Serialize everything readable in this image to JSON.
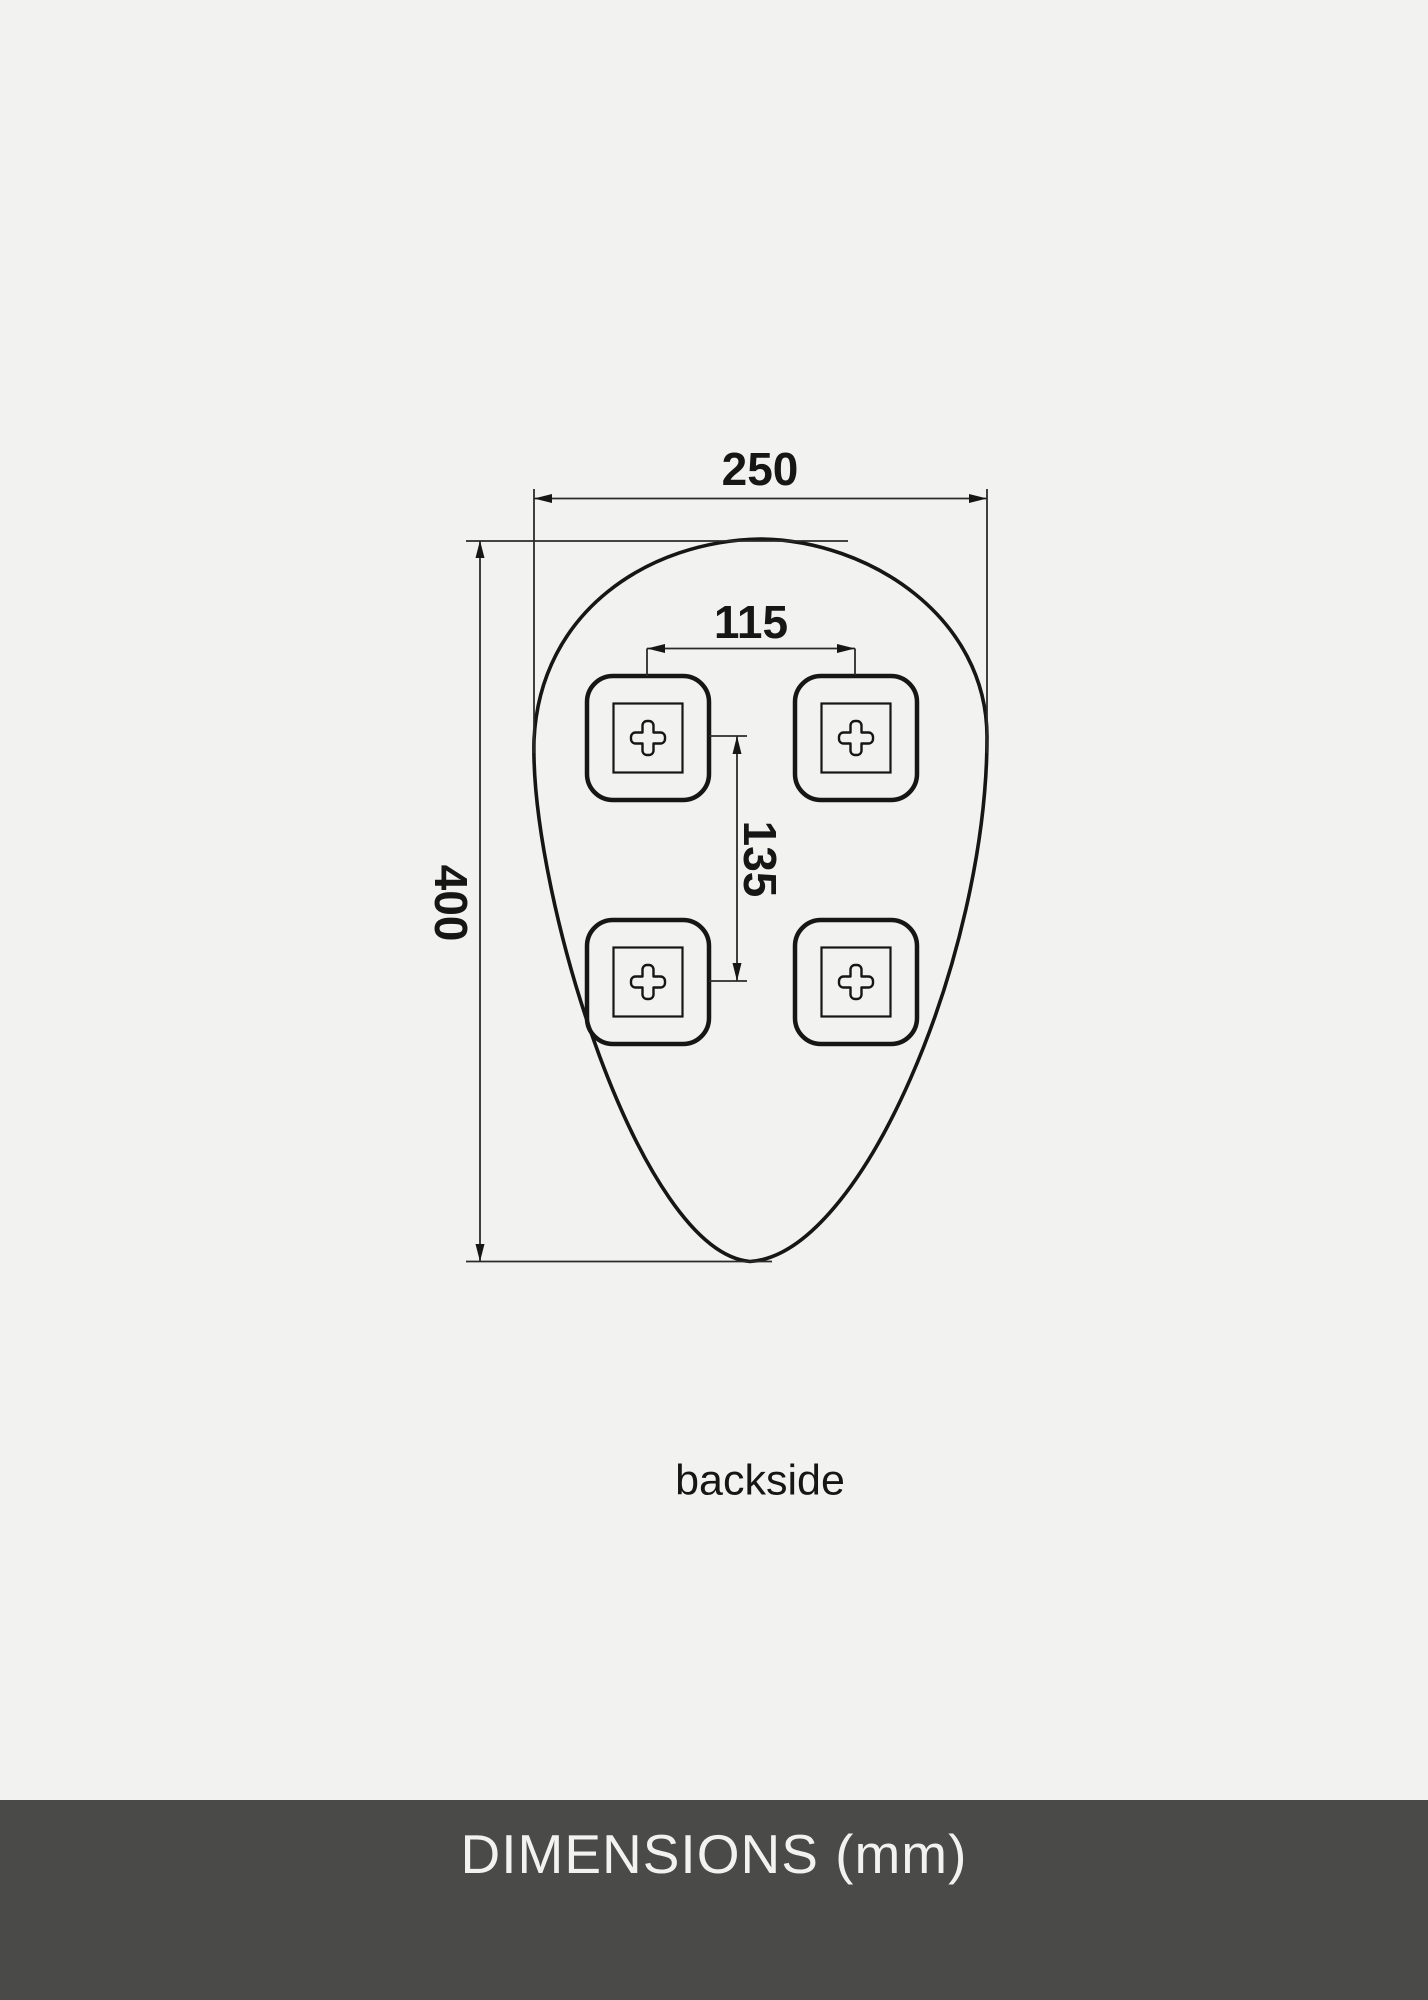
{
  "page": {
    "background_color": "#f2f2f0",
    "ink_color": "#161616",
    "dim_line_color": "#2b2b2b"
  },
  "diagram": {
    "caption": "backside",
    "dimensions": {
      "overall_width_mm": "250",
      "overall_height_mm": "400",
      "bracket_spacing_horizontal_mm": "115",
      "bracket_spacing_vertical_mm": "135"
    },
    "bracket_count": 4
  },
  "footer": {
    "title": "DIMENSIONS (mm)",
    "background_color": "#4a4a49",
    "text_color": "#f2f2f0"
  }
}
